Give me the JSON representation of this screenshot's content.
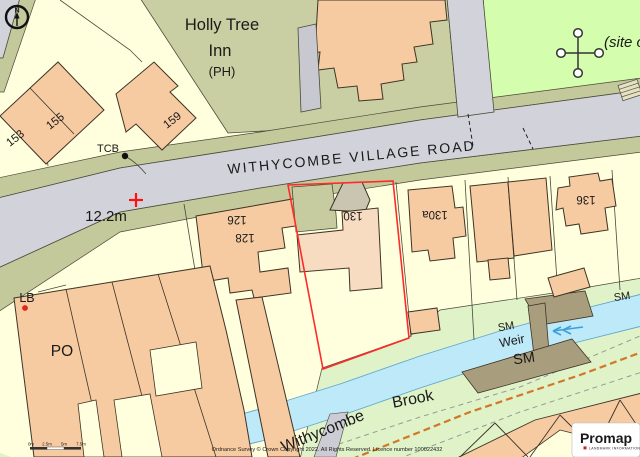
{
  "map": {
    "north_indicator": "N",
    "places": {
      "inn_line1": "Holly Tree",
      "inn_line2": "Inn",
      "inn_qualifier": "(PH)",
      "road_name": "WITHYCOMBE VILLAGE ROAD",
      "site_annotation": "(site o",
      "brook_name_word1": "Withycombe",
      "brook_name_word2": "Brook",
      "weir": "Weir"
    },
    "markers": {
      "tcb": "TCB",
      "lb": "LB",
      "po": "PO",
      "spot_height": "12.2m",
      "sm_west": "SM",
      "sm_big": "SM",
      "sm_east": "SM"
    },
    "house_numbers": {
      "n153": "153",
      "n155": "155",
      "n159": "159",
      "n126": "126",
      "n128": "128",
      "n130": "130",
      "n130a": "130a",
      "n136": "136"
    },
    "scale_bar": {
      "t0": "0m",
      "t1": "2.5m",
      "t2": "5m",
      "t3": "7.5m"
    },
    "footer": {
      "copyright": "Ordnance Survey © Crown Copyright 2022. All Rights Reserved. Licence number 100022432"
    },
    "logo": {
      "brand": "Promap",
      "tagline": "LANDMARK INFORMATION"
    },
    "colors": {
      "property_boundary": "#ff2a2a",
      "water": "#bee9f8",
      "water_edge": "#5fa8cc",
      "building": "#f6cba2",
      "building_light": "#f8dcc2",
      "road": "#d2d2da",
      "verge": "#c3c99a",
      "grounds": "#c9cfa2",
      "site_green": "#d5fdae",
      "bank_green": "#dff2c8",
      "structure_brown": "#a89e7e",
      "path_orange": "#d2772a",
      "brook_text": "#2e8fd0",
      "copyright_text": "#cc2200"
    }
  }
}
